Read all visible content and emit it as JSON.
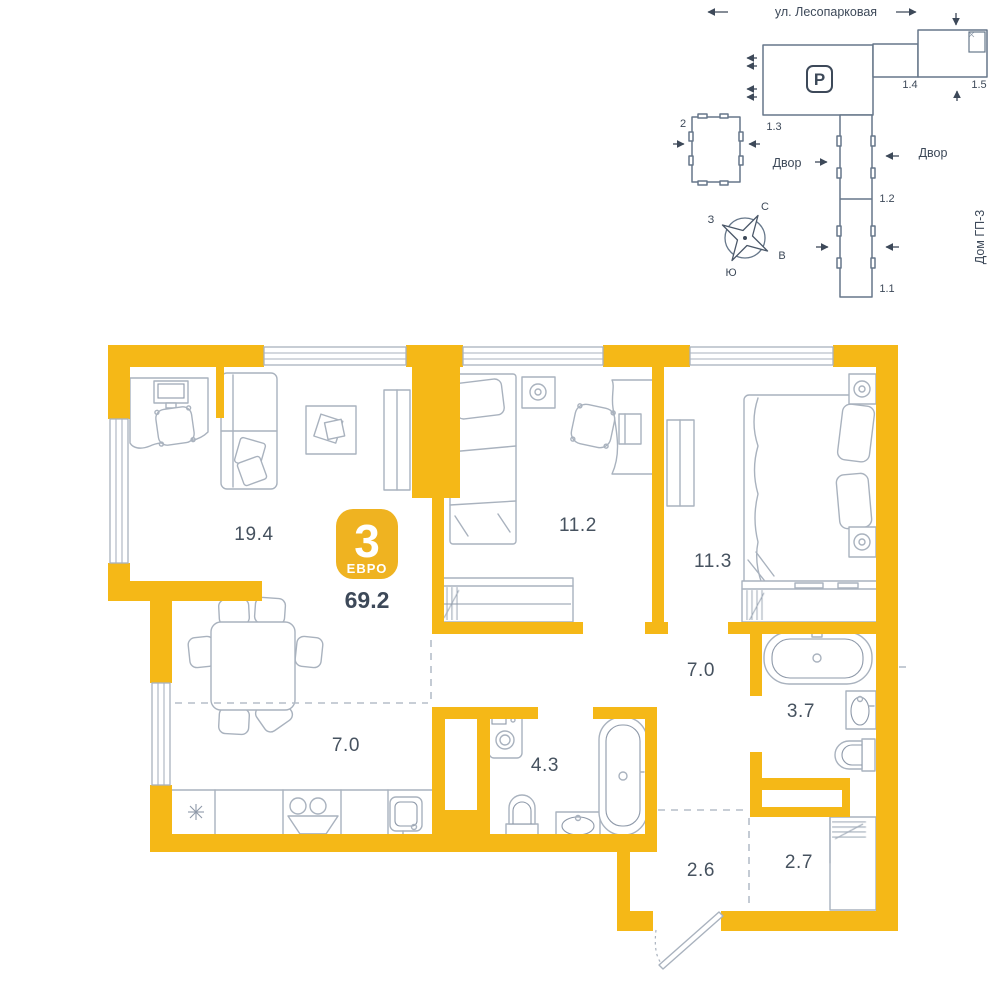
{
  "badge": {
    "rooms_count": "3",
    "type_label": "ЕВРО",
    "total_area": "69.2"
  },
  "rooms": {
    "living": "19.4",
    "kitchen": "7.0",
    "bedroom1": "11.2",
    "bedroom2": "11.3",
    "hallway": "7.0",
    "bathroom_big": "4.3",
    "bathroom_small": "3.7",
    "hall": "2.6",
    "closet": "2.7"
  },
  "site_plan": {
    "street": "ул. Лесопарковая",
    "courtyard_left": "Двор",
    "courtyard_right": "Двор",
    "house_label": "Дом ГП-3",
    "parking_letter": "P",
    "building_13": "1.3",
    "building_14": "1.4",
    "building_15": "1.5",
    "building_12": "1.2",
    "building_11": "1.1",
    "building_2": "2",
    "compass": {
      "n": "С",
      "s": "Ю",
      "w": "З",
      "e": "В"
    }
  },
  "colors": {
    "wall": "#F5B817",
    "badge": "#EFB321",
    "fur": "#A9B2BE",
    "furd": "#8E99A9",
    "text": "#3D4959",
    "site": "#66778A",
    "tile": "#E4E8ED",
    "dash": "#B6BEC9"
  }
}
